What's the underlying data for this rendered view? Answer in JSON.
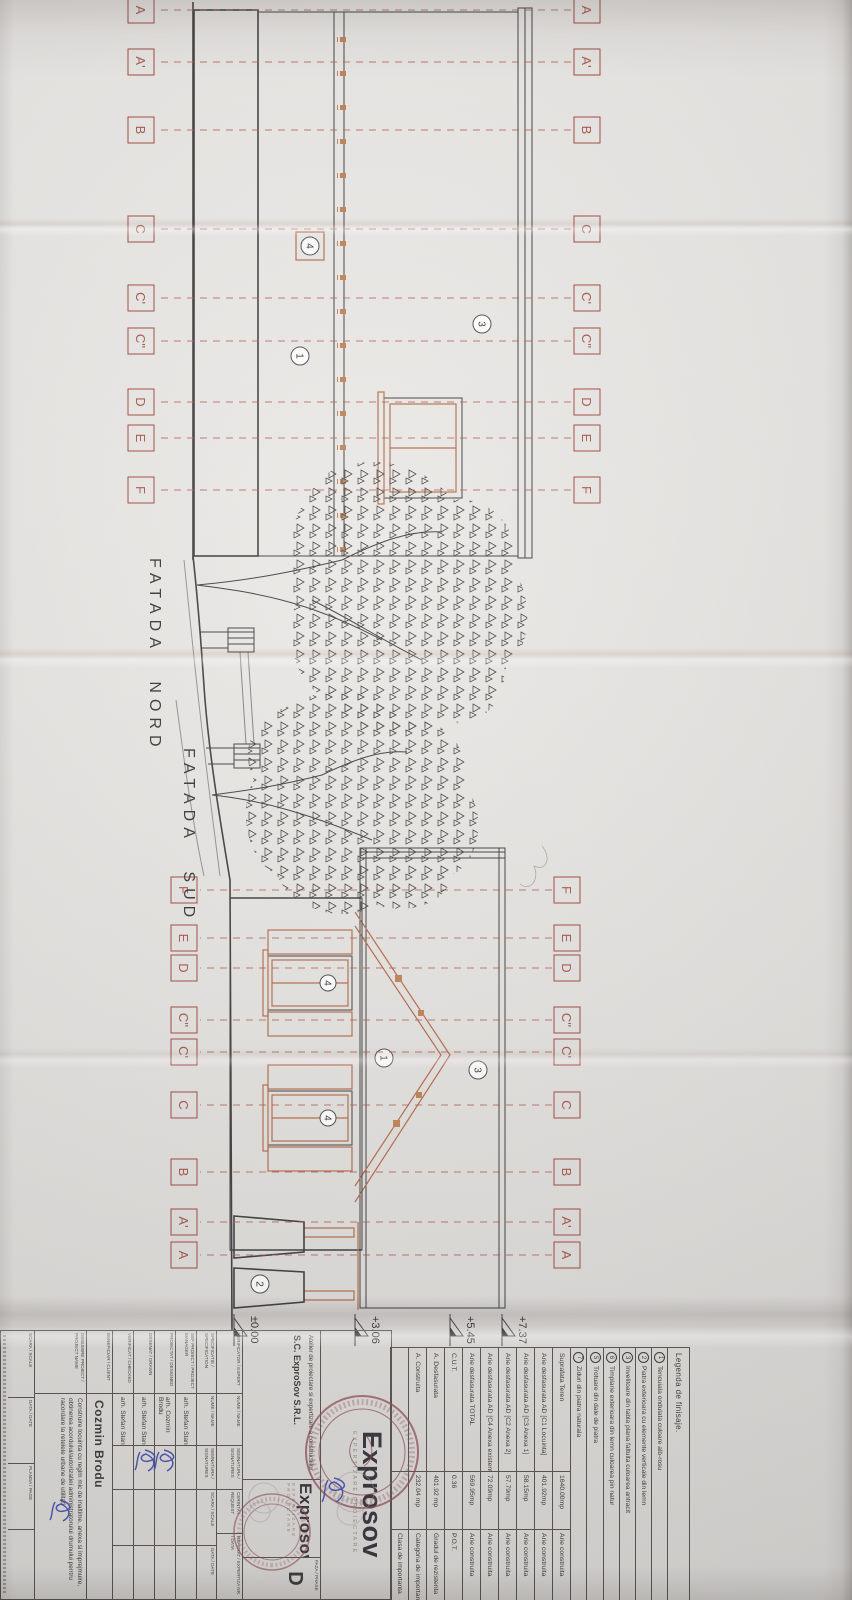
{
  "sheet": {
    "facade_north_label": "FATADA NORD",
    "facade_south_label": "FATADA SUD"
  },
  "axes": {
    "letters": [
      "A",
      "A'",
      "B",
      "C",
      "C'",
      "C''",
      "D",
      "E",
      "F"
    ]
  },
  "elevations": {
    "values": [
      "±0.00",
      "+3.06",
      "+5.45",
      "+7.37"
    ]
  },
  "callouts": {
    "render": "1",
    "stone": "2",
    "roof": "3",
    "window": "4"
  },
  "legend": {
    "title": "Legenda de finisaje.",
    "items": [
      {
        "num": "1",
        "text": "Tencuiala ondulata culoare alb-rosu"
      },
      {
        "num": "2",
        "text": "Piatra exterioara cu elemente verticale din lemn"
      },
      {
        "num": "3",
        "text": "Invelitoare din tabla plana faltuita culoarea antracit"
      },
      {
        "num": "6",
        "text": "Timplarie exterioara din lemn culoarea pin natur"
      },
      {
        "num": "5",
        "text": "Trotuare din dale de piatra"
      },
      {
        "num": "7",
        "text": "Ziduri din piatra naturala"
      }
    ]
  },
  "statistics": {
    "rows": [
      {
        "label": "Suprafata Teren",
        "value": "1640.00mp",
        "note": "Arie construita"
      },
      {
        "label": "Arie desfasurata AD [C1 Locuinta]",
        "value": "401.92mp",
        "note": "Arie construita"
      },
      {
        "label": "Arie desfasurata AD [C3 Anexa 1]",
        "value": "58.15mp",
        "note": "Arie construita"
      },
      {
        "label": "Arie desfasurata AD [C2 Anexa 2]",
        "value": "57.79mp",
        "note": "Arie construita"
      },
      {
        "label": "Arie desfasurata AD [C4 Anexa existenta]",
        "value": "72.09mp",
        "note": "Arie construita"
      },
      {
        "label": "Arie desfasurata TOTAL",
        "value": "569.95mp",
        "note": "Arie construita"
      },
      {
        "label": "C.U.T.",
        "value": "0.36",
        "note": "P.O.T."
      },
      {
        "label": "A. Desfasurata",
        "value": "401.92 mp",
        "note": "Gradul de rezistenta"
      },
      {
        "label": "A. Construita",
        "value": "232.04 mp",
        "note": "Categoria de importanta"
      },
      {
        "label": "",
        "value": "",
        "note": "Clasa de importanta"
      }
    ]
  },
  "title_block": {
    "company": "S.C. ExproSov S.R.L.",
    "atelier": "Atelier de proiectare si expertizare a constructiilor",
    "logo": "Exprosov",
    "logo_tagline": "EXPERTIZARE PROIECTARE",
    "verif_header": {
      "role": "VERIFICATOR / EXPERT",
      "name": "NUME / NAME",
      "signature": "SEMNATURA / SIGNATURES",
      "requirement": "CERINTA / REQUEST",
      "report": "REFERAT / EXPERTIZA NR. / DATA"
    },
    "table_header": {
      "spec": "SPECIFICATIE / SPECIFICATION",
      "name": "NUME / NAME",
      "signature": "SEMNATURA / SIGNATURES",
      "scale": "SCARA / SCALE",
      "date": "DATA / DATE"
    },
    "personnel": [
      {
        "role": "SEF PROIECT / PROJECT MANAGER",
        "name": "arh. Stefan Stan"
      },
      {
        "role": "PROIECTAT / DESIGNED",
        "name": "arh. Cozmin Brodu"
      },
      {
        "role": "DESENAT / DRAWN",
        "name": "arh. Stefan Stan"
      },
      {
        "role": "VERIFICAT / CHECKED",
        "name": "arh. Stefan Stan"
      }
    ],
    "beneficiary_label": "BENEFICIAR / CLIENT",
    "beneficiary": "Cozmin Brodu",
    "project_label": "DENUMIRE PROIECT / PROJECT NAME",
    "project_description": "Construire locuinta cu regim mic de inaltime, anexa si imprejmuire, obtinerea acordului/autorizatiei administratorului drumului pentru racordare la retelele urbane de utilitati",
    "scale_label": "SCARA / SCALE",
    "date_label": "DATA / DATE",
    "sheet_label": "PLANSA / PAGE",
    "phase_label": "FAZA / PHASE",
    "phase_value": "D"
  }
}
